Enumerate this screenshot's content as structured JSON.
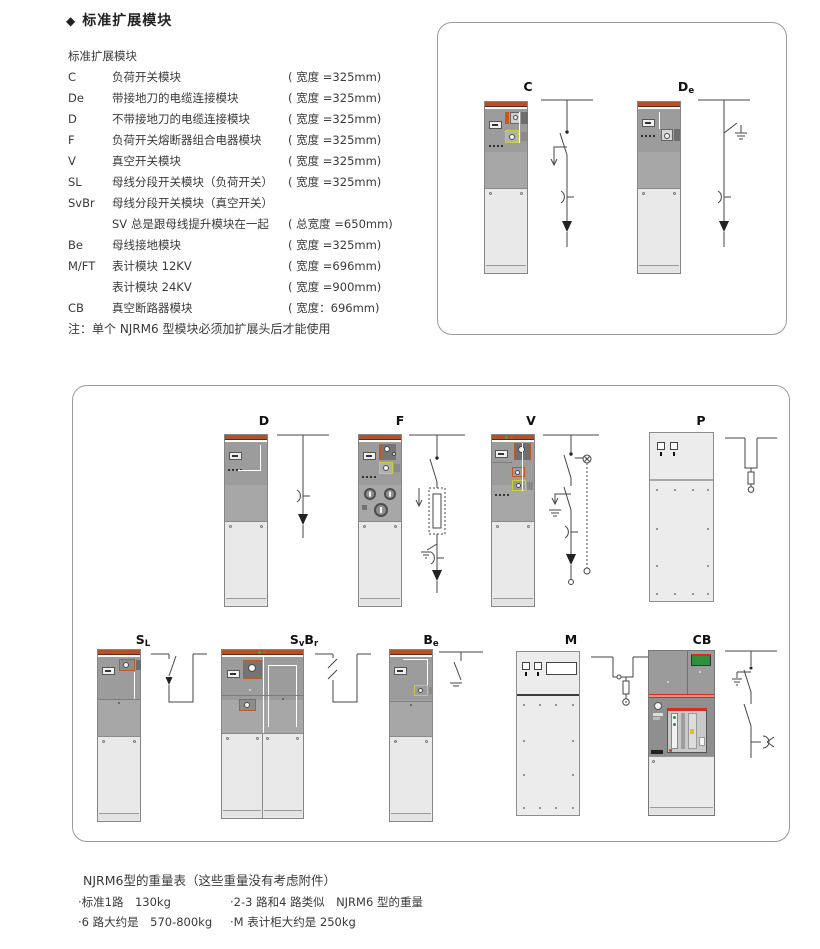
{
  "header": {
    "bullet": "◆",
    "title": "标准扩展模块"
  },
  "list": {
    "heading": "标准扩展模块",
    "rows": [
      {
        "code": "C",
        "desc": "负荷开关模块",
        "width": "( 宽度 =325mm)"
      },
      {
        "code": "De",
        "desc": "带接地刀的电缆连接模块",
        "width": "( 宽度 =325mm)"
      },
      {
        "code": "D",
        "desc": "不带接地刀的电缆连接模块",
        "width": "( 宽度 =325mm)"
      },
      {
        "code": "F",
        "desc": "负荷开关熔断器组合电器模块",
        "width": "( 宽度 =325mm)"
      },
      {
        "code": "V",
        "desc": "真空开关模块",
        "width": "( 宽度 =325mm)"
      },
      {
        "code": "SL",
        "desc": "母线分段开关模块（负荷开关）",
        "width": "( 宽度 =325mm)"
      },
      {
        "code": "SvBr",
        "desc": "母线分段开关模块（真空开关）",
        "width": ""
      },
      {
        "code": "",
        "desc": "SV 总是跟母线提升模块在一起",
        "width": "( 总宽度 =650mm)"
      },
      {
        "code": "Be",
        "desc": "母线接地模块",
        "width": "( 宽度 =325mm)"
      },
      {
        "code": "M/FT",
        "desc": "表计模块 12KV",
        "width": "( 宽度 =696mm)"
      },
      {
        "code": "",
        "desc": "表计模块 24KV",
        "width": "( 宽度 =900mm)"
      },
      {
        "code": "CB",
        "desc": "真空断路器模块",
        "width": "( 宽度：696mm)"
      }
    ],
    "note": "注：单个 NJRM6 型模块必须加扩展头后才能使用"
  },
  "diagram_labels": {
    "c": {
      "l1": "C"
    },
    "de": {
      "l1": "D",
      "s1": "e"
    },
    "d": {
      "l1": "D"
    },
    "f": {
      "l1": "F"
    },
    "v": {
      "l1": "V"
    },
    "p": {
      "l1": "P"
    },
    "sl": {
      "l1": "S",
      "s1": "L"
    },
    "svbr": {
      "l1": "S",
      "s1": "v",
      "l2": "B",
      "s2": "r"
    },
    "be": {
      "l1": "B",
      "s1": "e"
    },
    "m": {
      "l1": "M"
    },
    "cb": {
      "l1": "CB"
    }
  },
  "weights": {
    "heading": "NJRM6型的重量表（这些重量没有考虑附件）",
    "r1c1": "·标准1路　130kg",
    "r1c2": "·2-3 路和4 路类似　NJRM6 型的重量",
    "r2c1": "·6 路大约是　570-800kg",
    "r2c2": "·M 表计柜大约是 250kg"
  },
  "colors": {
    "cabinet_orange_strip": "#b3522a",
    "cabinet_gray": "#9c9c9c",
    "door_gray": "#e9e9e9",
    "cb_stripe_red": "#d92b20",
    "cb_screen_green": "#2f8f3f",
    "device_yellow_border": "#c9cf3a",
    "device_orange_border": "#c4581f"
  }
}
